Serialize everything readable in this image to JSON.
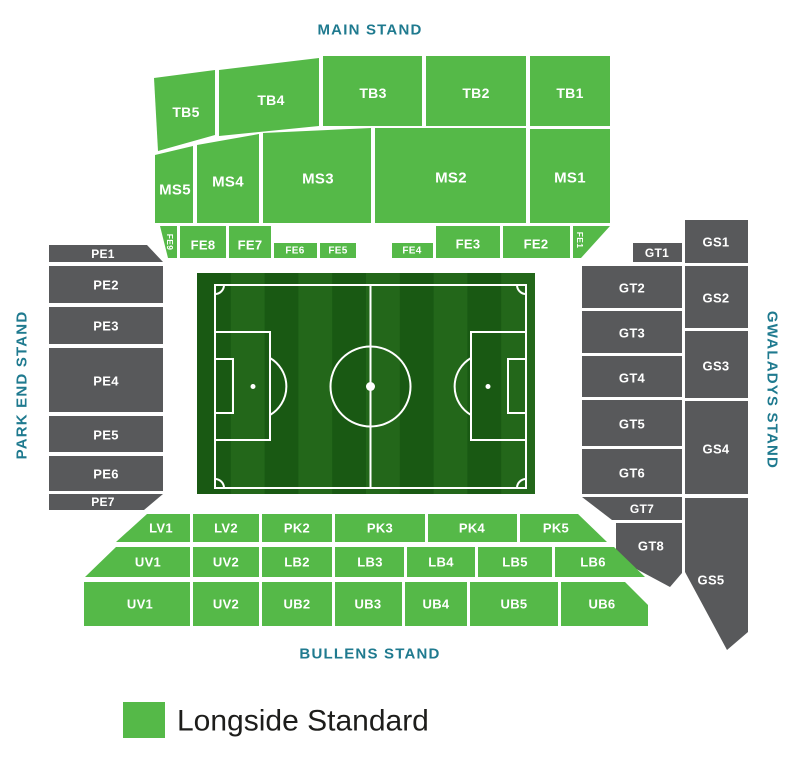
{
  "stand_labels": {
    "main": "MAIN STAND",
    "park_end": "PARK END STAND",
    "gwaladys": "GWALADYS STAND",
    "bullens": "BULLENS STAND"
  },
  "sections": {
    "tb5": "TB5",
    "tb4": "TB4",
    "tb3": "TB3",
    "tb2": "TB2",
    "tb1": "TB1",
    "ms5": "MS5",
    "ms4": "MS4",
    "ms3": "MS3",
    "ms2": "MS2",
    "ms1": "MS1",
    "fe9": "FE9",
    "fe8": "FE8",
    "fe7": "FE7",
    "fe6": "FE6",
    "fe5": "FE5",
    "fe4": "FE4",
    "fe3": "FE3",
    "fe2": "FE2",
    "fe1": "FE1",
    "pe1": "PE1",
    "pe2": "PE2",
    "pe3": "PE3",
    "pe4": "PE4",
    "pe5": "PE5",
    "pe6": "PE6",
    "pe7": "PE7",
    "gt1": "GT1",
    "gt2": "GT2",
    "gt3": "GT3",
    "gt4": "GT4",
    "gt5": "GT5",
    "gt6": "GT6",
    "gt7": "GT7",
    "gt8": "GT8",
    "gs1": "GS1",
    "gs2": "GS2",
    "gs3": "GS3",
    "gs4": "GS4",
    "gs5": "GS5",
    "lv1": "LV1",
    "lv2": "LV2",
    "pk2": "PK2",
    "pk3": "PK3",
    "pk4": "PK4",
    "pk5": "PK5",
    "uv1_mid": "UV1",
    "uv2_mid": "UV2",
    "lb2": "LB2",
    "lb3": "LB3",
    "lb4": "LB4",
    "lb5": "LB5",
    "lb6": "LB6",
    "uv1_low": "UV1",
    "uv2_low": "UV2",
    "ub2": "UB2",
    "ub3": "UB3",
    "ub4": "UB4",
    "ub5": "UB5",
    "ub6": "UB6"
  },
  "legend": {
    "items": [
      {
        "label": "Longside Standard",
        "color": "#55b948"
      }
    ]
  },
  "colors": {
    "longside_standard": "#55b948",
    "unavailable_section": "#58595b",
    "stand_label_text": "#1f7a8f",
    "section_label_text": "#ffffff",
    "pitch_stripe_dark": "#1f6e18",
    "pitch_stripe_light": "#2b7f21",
    "pitch_line": "#ffffff"
  }
}
